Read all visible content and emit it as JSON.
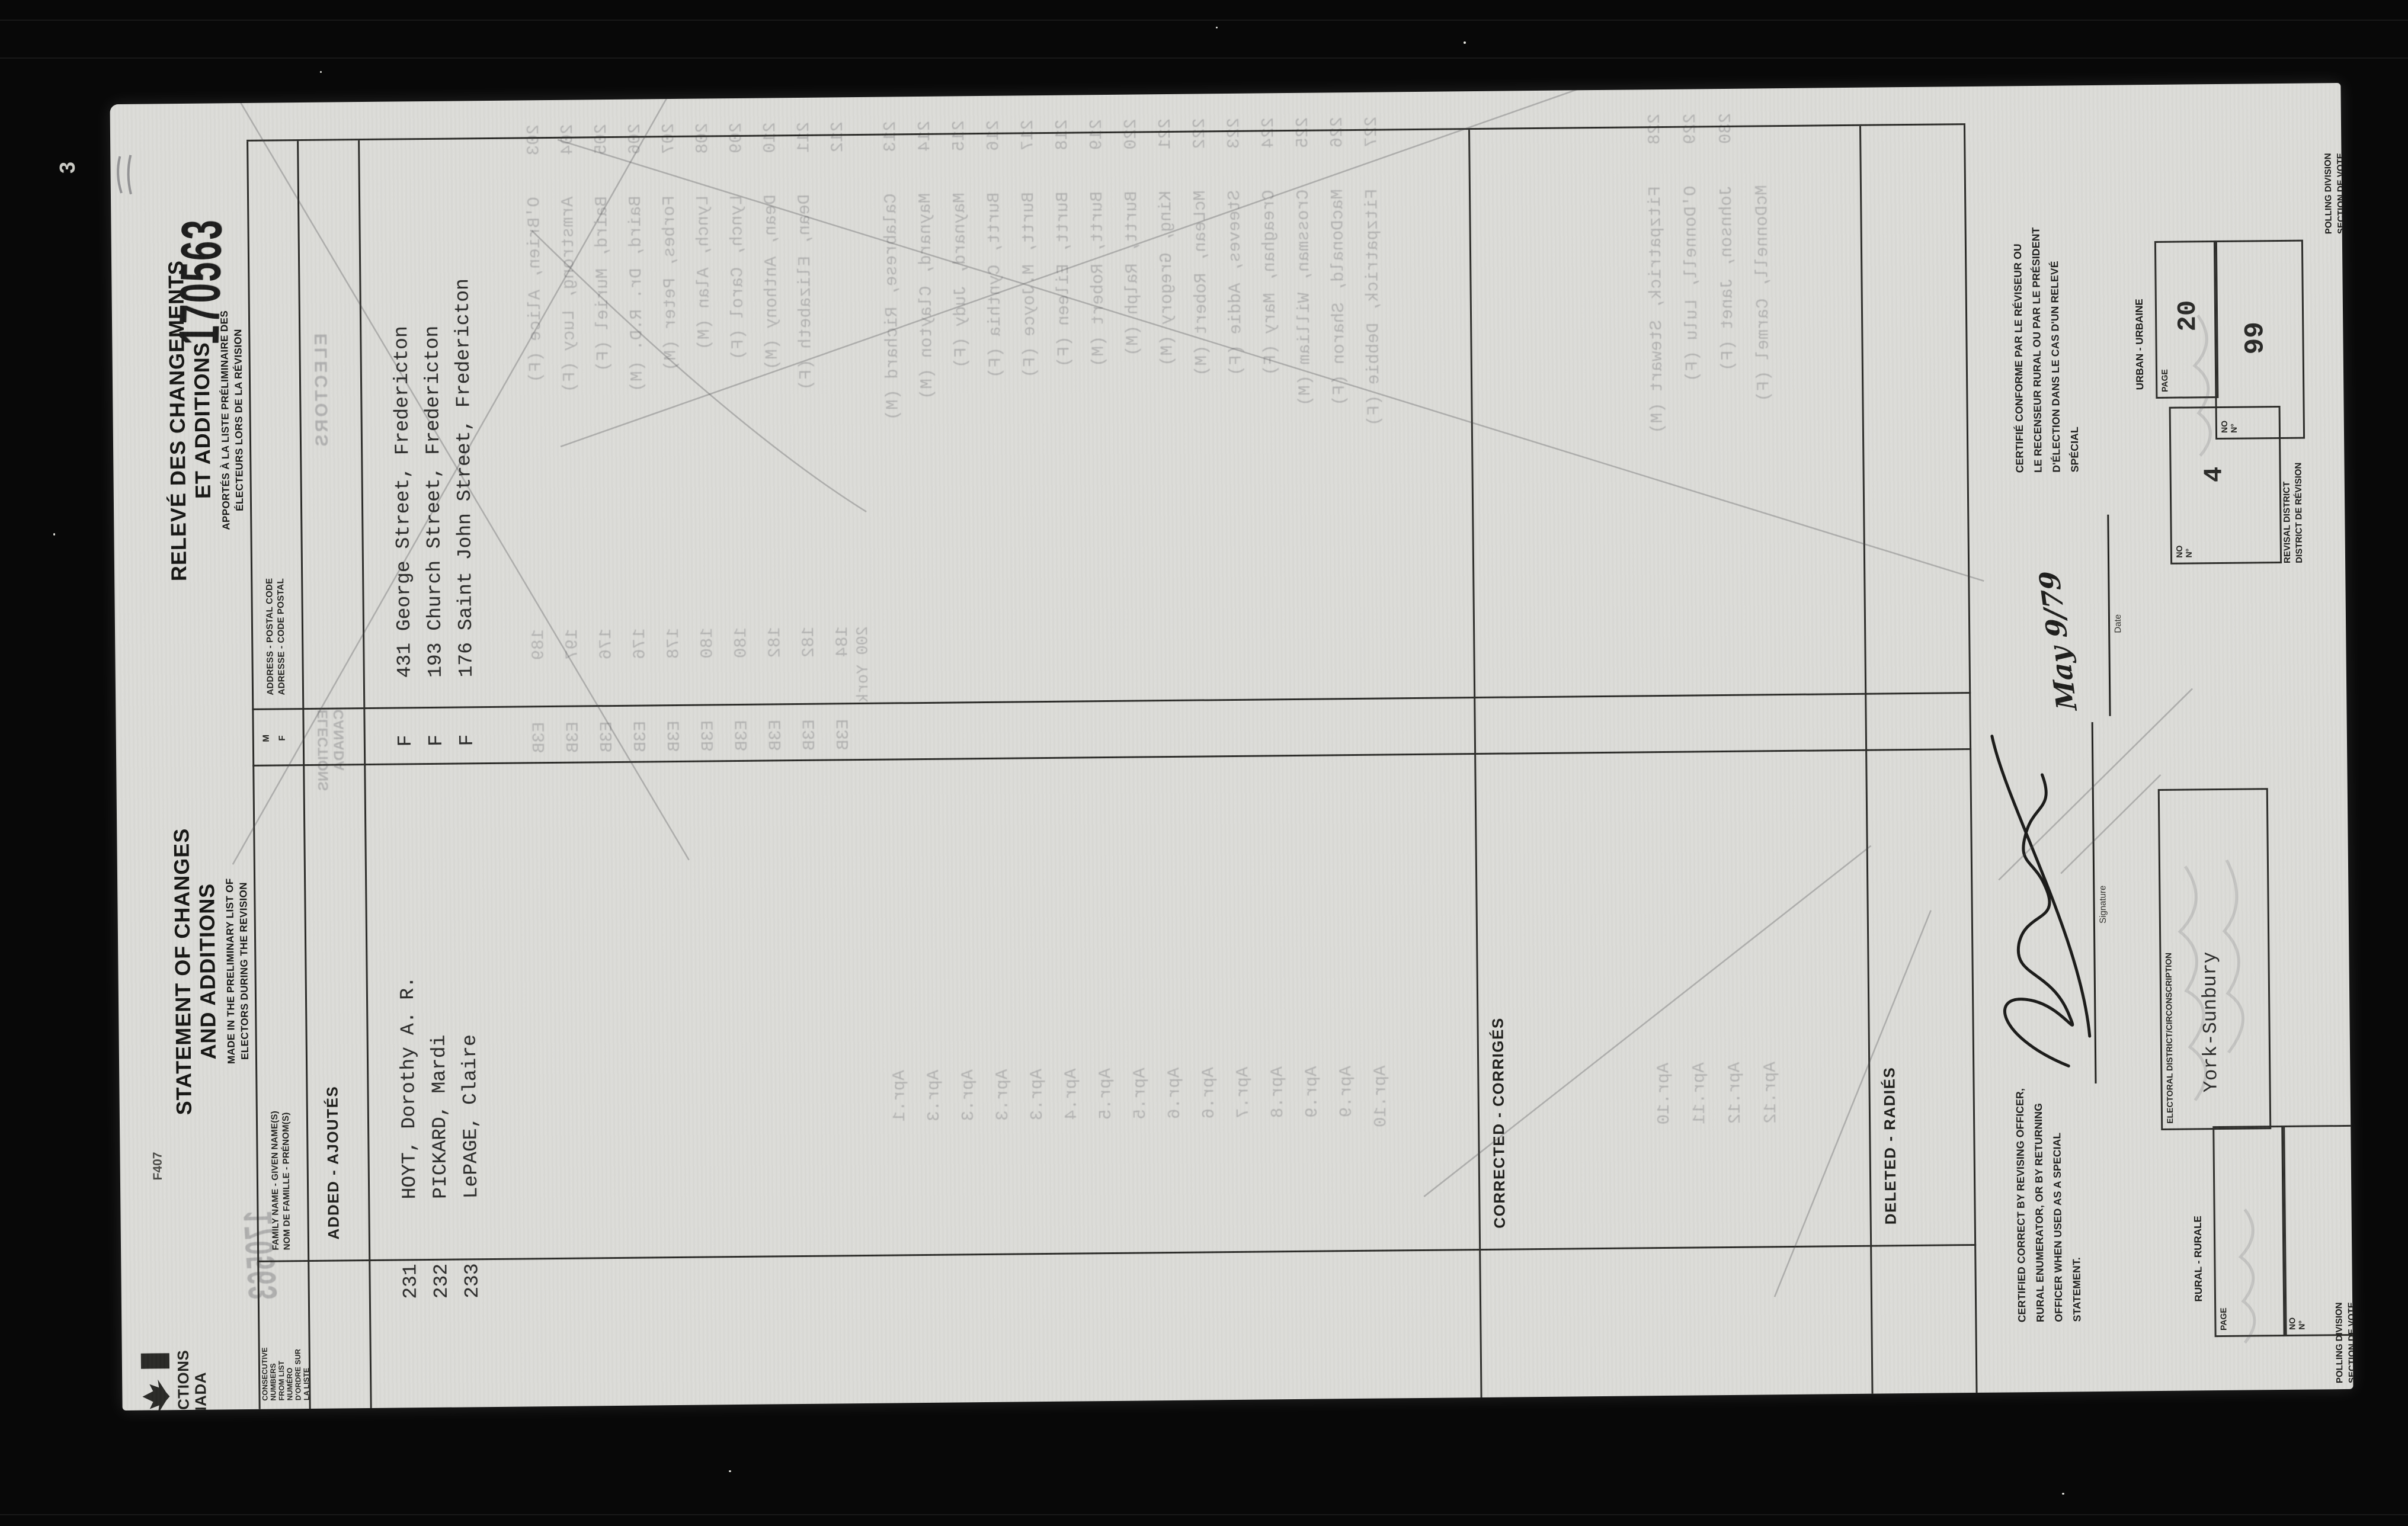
{
  "film": {
    "frame_number": "3"
  },
  "stamp": "170563",
  "header": {
    "form_number": "F407",
    "agency": [
      "ELECTIONS",
      "CANADA"
    ],
    "title_en": [
      "STATEMENT OF CHANGES",
      "AND ADDITIONS"
    ],
    "subtitle_en": [
      "MADE IN THE PRELIMINARY LIST OF",
      "ELECTORS DURING THE REVISION"
    ],
    "title_fr": [
      "RELEVÉ DES CHANGEMENTS",
      "ET ADDITIONS"
    ],
    "subtitle_fr": [
      "APPORTÉS À LA LISTE PRÉLIMINAIRE DES",
      "ÉLECTEURS LORS DE LA RÉVISION"
    ]
  },
  "table": {
    "col_consecutive_en": [
      "CONSECUTIVE",
      "NUMBERS",
      "FROM LIST"
    ],
    "col_consecutive_fr": [
      "NUMÉRO",
      "D'ORDRE SUR",
      "LA LISTE"
    ],
    "col_name_en": "FAMILY NAME - GIVEN NAME(S)",
    "col_name_fr": "NOM DE FAMILLE - PRÉNOM(S)",
    "col_sex_m": "M",
    "col_sex_f": "F",
    "col_address_en": "ADDRESS - POSTAL CODE",
    "col_address_fr": "ADRESSE - CODE POSTAL",
    "section_added": "ADDED - AJOUTÉS",
    "section_corrected": "CORRECTED - CORRIGÉS",
    "section_deleted": "DELETED - RADIÉS",
    "added_rows": [
      {
        "num": "231",
        "name": "HOYT, Dorothy A. R.",
        "sex": "F",
        "address": "431 George Street, Fredericton"
      },
      {
        "num": "232",
        "name": "PICKARD, Mardi",
        "sex": "F",
        "address": "193 Church Street, Fredericton"
      },
      {
        "num": "233",
        "name": "LePAGE, Claire",
        "sex": "F",
        "address": "176 Saint John Street, Fredericton"
      }
    ]
  },
  "footer": {
    "certify_en": [
      "CERTIFIED CORRECT BY REVISING OFFICER,",
      "RURAL ENUMERATOR, OR BY RETURNING",
      "OFFICER WHEN USED AS A SPECIAL",
      "STATEMENT."
    ],
    "certify_fr": [
      "CERTIFIÉ CONFORME PAR LE RÉVISEUR OU",
      "LE RECENSEUR RURAL OU PAR LE PRÉSIDENT",
      "D'ÉLECTION DANS LE CAS D'UN RELEVÉ",
      "SPÉCIAL"
    ],
    "signature_label": "Signature",
    "date_label": "Date",
    "date_value": "May 9/79",
    "electoral_district_label": "ELECTORAL DISTRICT/CIRCONSCRIPTION",
    "electoral_district_value": "York-Sunbury",
    "urban_label": "URBAN - URBAINE",
    "rural_label": "RURAL - RURALE",
    "page_label": "PAGE",
    "no_label_en": "NO",
    "no_label_fr": "N°",
    "urban_page": "20",
    "urban_no": "99",
    "revisal_no": "4",
    "revisal_label": [
      "REVISAL DISTRICT",
      "DISTRICT DE RÉVISION"
    ],
    "polling_label": [
      "POLLING DIVISION",
      "SECTION DE VOTE"
    ]
  },
  "bleedthrough": {
    "electors_stamp": "ELECTORS",
    "stamp": "170563",
    "agency": [
      "ELECTIONS",
      "CANADA"
    ],
    "area_note": "200 York",
    "rows_a": [
      {
        "num": "203",
        "name": "O'Brien, Alice (F)",
        "addr": "189      E3B",
        "date": ""
      },
      {
        "num": "204",
        "name": "Armstrong, Lucy (F)",
        "addr": "197      E3B",
        "date": ""
      },
      {
        "num": "205",
        "name": "Baird, Muriel (F)",
        "addr": "176      E3B",
        "date": ""
      },
      {
        "num": "206",
        "name": "Baird, Dr. R.D. (M)",
        "addr": "176      E3B",
        "date": ""
      },
      {
        "num": "207",
        "name": "Forbes, Peter (M)",
        "addr": "178      E3B",
        "date": ""
      },
      {
        "num": "208",
        "name": "Lynch, Alan (M)",
        "addr": "180      E3B",
        "date": ""
      },
      {
        "num": "209",
        "name": "Lynch, Carol (F)",
        "addr": "180      E3B",
        "date": ""
      },
      {
        "num": "210",
        "name": "Dean, Anthony (M)",
        "addr": "182      E3B",
        "date": ""
      },
      {
        "num": "211",
        "name": "Dean, Elizabeth (F)",
        "addr": "182      E3B",
        "date": ""
      },
      {
        "num": "212",
        "name": "",
        "addr": "184      E3B",
        "date": ""
      }
    ],
    "rows_b": [
      {
        "num": "213",
        "name": "Calabrese, Richard (M)",
        "addr": "",
        "date": "Apr.1"
      },
      {
        "num": "214",
        "name": "Maynard, Clayton (M)",
        "addr": "",
        "date": "Apr.3"
      },
      {
        "num": "215",
        "name": "Maynard, Judy (F)",
        "addr": "",
        "date": "Apr.3"
      },
      {
        "num": "216",
        "name": "Burtt, Cynthia (F)",
        "addr": "",
        "date": "Apr.3"
      },
      {
        "num": "217",
        "name": "Burtt, M.Joyce (F)",
        "addr": "",
        "date": "Apr.3"
      },
      {
        "num": "218",
        "name": "Burtt, Eileen (F)",
        "addr": "",
        "date": "Apr.4"
      },
      {
        "num": "219",
        "name": "Burtt, Robert (M)",
        "addr": "",
        "date": "Apr.5"
      },
      {
        "num": "220",
        "name": "Burtt, Ralph (M)",
        "addr": "",
        "date": "Apr.5"
      },
      {
        "num": "221",
        "name": "King, Gregory (M)",
        "addr": "",
        "date": "Apr.6"
      },
      {
        "num": "222",
        "name": "McLean, Robert (M)",
        "addr": "",
        "date": "Apr.6"
      },
      {
        "num": "223",
        "name": "Steeves, Addie (F)",
        "addr": "",
        "date": "Apr.7"
      },
      {
        "num": "224",
        "name": "Creaghan, Mary (F)",
        "addr": "",
        "date": "Apr.8"
      },
      {
        "num": "225",
        "name": "Crossman, William (M)",
        "addr": "",
        "date": "Apr.9"
      },
      {
        "num": "226",
        "name": "MacDonald, Sharon (F)",
        "addr": "",
        "date": "Apr.9"
      },
      {
        "num": "227",
        "name": "Fitzpatrick, Debbie (F)",
        "addr": "",
        "date": "Apr.10"
      }
    ],
    "rows_c": [
      {
        "num": "228",
        "name": "Fitzpatrick, Stewart (M)",
        "addr": "",
        "date": "Apr.10"
      },
      {
        "num": "229",
        "name": "O'Donnell, Lulu (F)",
        "addr": "",
        "date": "Apr.11"
      },
      {
        "num": "230",
        "name": "Johnson, Janet (F)",
        "addr": "",
        "date": "Apr.12"
      },
      {
        "num": "",
        "name": "McDonnell, Carmel (F)",
        "addr": "",
        "date": "Apr.12"
      }
    ]
  }
}
